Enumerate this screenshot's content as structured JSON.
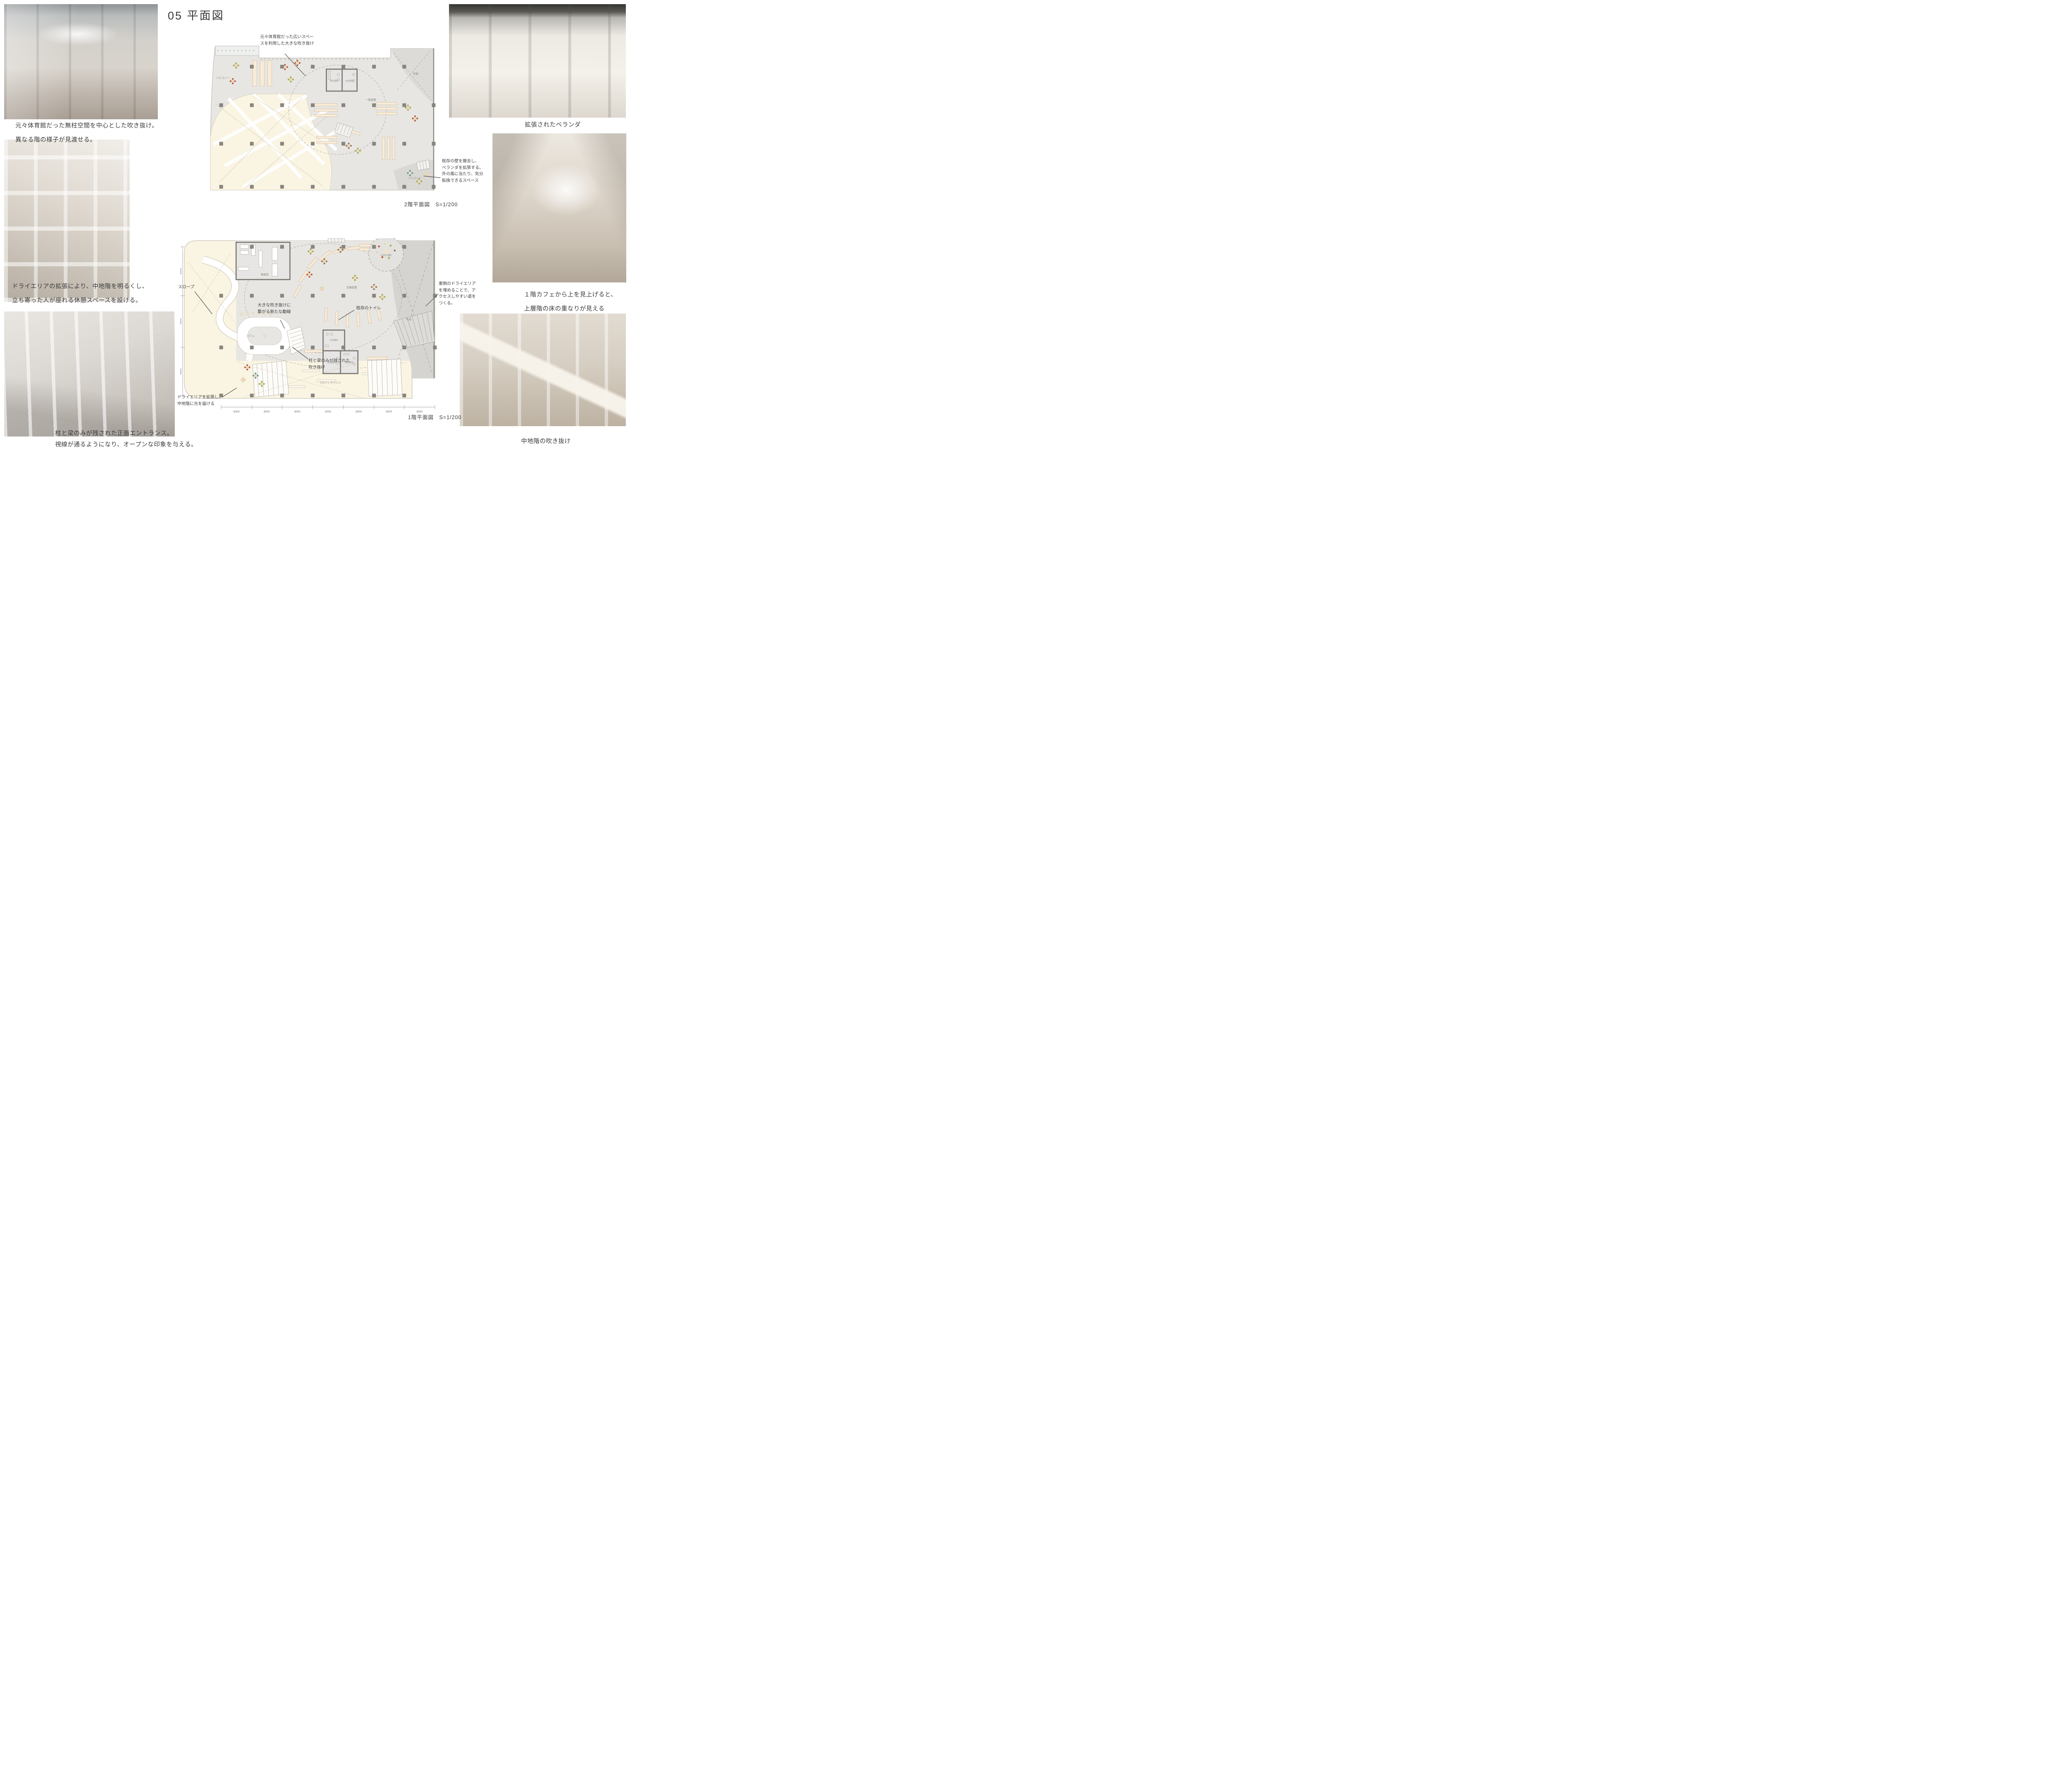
{
  "title": "05 平面図",
  "captions": {
    "photo1_line1": "元々体育館だった無柱空間を中心とした吹き抜け。",
    "photo1_line2": "異なる階の様子が見渡せる。",
    "photo2_line1": "ドライエリアの拡張により、中地階を明るくし、",
    "photo2_line2": "立ち寄った人が座れる休憩スペースを設ける。",
    "photo3_line1": "柱と梁のみが残された正面エントランス。",
    "photo3_line2": "視線が通るようになり、オープンな印象を与える。",
    "photo4": "拡張されたベランダ",
    "photo5_line1": "１階カフェから上を見上げると、",
    "photo5_line2": "上層階の床の重なりが見える",
    "photo6": "中地階の吹き抜け"
  },
  "plan2f": {
    "title": "2階平面図　S=1/200",
    "annotation_void_line1": "元々体育館だった広いスペー",
    "annotation_void_line2": "スを利用した大きな吹き抜け",
    "annotation_veranda_line1": "既存の壁を撤去し、",
    "annotation_veranda_line2": "ベランダを拡張する。",
    "annotation_veranda_line3": "外の風に当たり、気分",
    "annotation_veranda_line4": "転換できるスペース",
    "rooms": {
      "balcony_top": "バルコニー",
      "mens_toilet": "男性便所",
      "womens_toilet": "女性便所",
      "general_books": "一般図書",
      "void": "吹抜",
      "balcony_bottom": "バルコニー"
    }
  },
  "plan1f": {
    "title": "1階平面図　S=1/200",
    "annotations": {
      "slope": "スロープ",
      "flow_line1": "大きな吹き抜けに",
      "flow_line2": "繋がる新たな動線",
      "existing_toilet": "既存のトイレ",
      "east_line1": "東側のドライエリア",
      "east_line2": "を埋めることで、ア",
      "east_line3": "クセスしやすい道を",
      "east_line4": "つくる。",
      "void_line1": "柱と梁のみが残された",
      "void_line2": "吹き抜け",
      "dry_line1": "ドライエリアを拡張し、",
      "dry_line2": "中地階に光を届ける"
    },
    "rooms": {
      "office": "事務室",
      "cafe": "カフェ",
      "children_books": "児童図書",
      "story_room": "お話の部屋",
      "kids_toilet": "子供便所",
      "womens_toilet": "女性便所",
      "mens_toilet": "男性便所",
      "magazine_lounge": "マガジンラウンジ",
      "void": "吹抜"
    },
    "dims_bottom": [
      "8000",
      "8000",
      "8000",
      "8000",
      "8000",
      "8000",
      "8000"
    ],
    "dims_left": [
      "9000",
      "9000",
      "8000"
    ]
  },
  "colors": {
    "plan_floor": "#e7e6e3",
    "plan_void_cream": "#faf4e2",
    "plan_dark_gray": "#d5d4d0",
    "column": "#8b8680",
    "wall": "#787571",
    "furniture": "#f8ecd9",
    "text_dark": "#3c3c3c",
    "text_gray": "#8f8b85"
  }
}
